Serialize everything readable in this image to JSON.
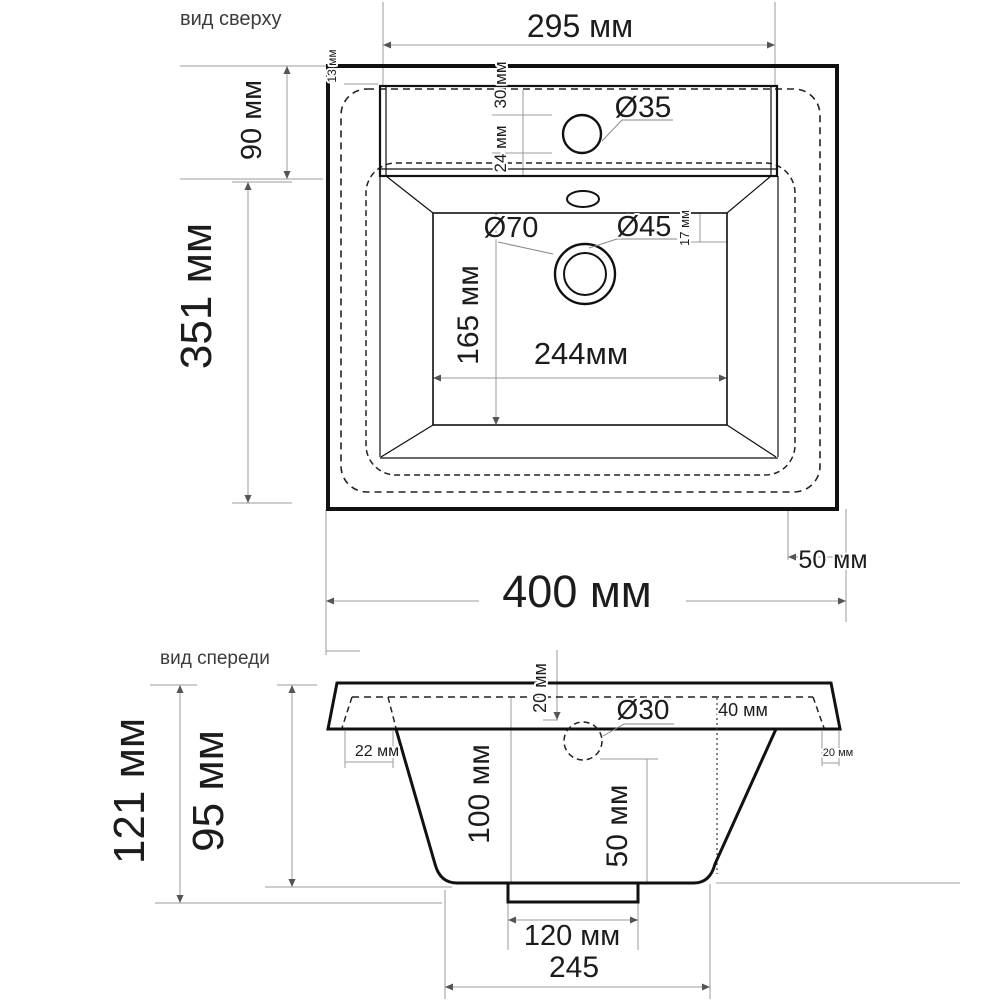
{
  "top_view": {
    "label": "вид сверху",
    "dim_295": "295 мм",
    "dim_13": "13 мм",
    "dim_90": "90 мм",
    "dim_351": "351 мм",
    "dim_30": "30 мм",
    "dim_24": "24 мм",
    "dia_35": "Ø35",
    "dia_70": "Ø70",
    "dia_45": "Ø45",
    "dim_17": "17 мм",
    "dim_165": "165 мм",
    "dim_244": "244мм",
    "dim_400": "400 мм",
    "dim_50": "50 мм"
  },
  "front_view": {
    "label": "вид спереди",
    "dim_121": "121 мм",
    "dim_95": "95 мм",
    "dim_20_top": "20 мм",
    "dia_30": "Ø30",
    "dim_40": "40 мм",
    "dim_22": "22 мм",
    "dim_20_right": "20 мм",
    "dim_100": "100 мм",
    "dim_50": "50 мм",
    "dim_120": "120 мм",
    "dim_245": "245"
  },
  "colors": {
    "outline": "#111111",
    "dimension_line": "#9b9b9b",
    "text": "#1c1c1c",
    "background": "#ffffff"
  }
}
